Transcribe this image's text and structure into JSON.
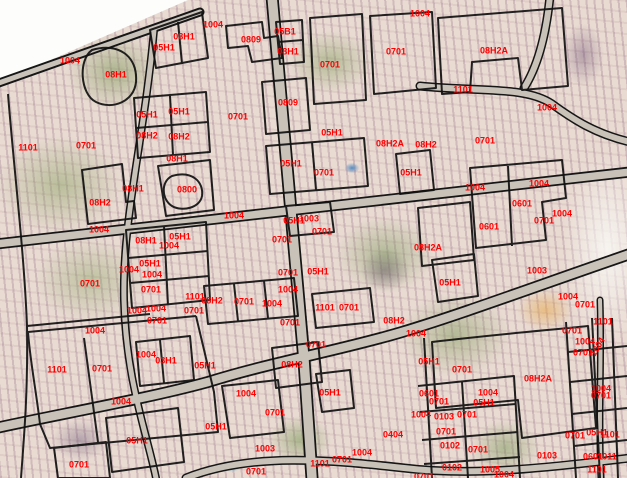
{
  "map": {
    "title": "cadastral parcel overlay on aerial imagery",
    "label_color": "#ff0000",
    "boundary_color": "#111111",
    "road_fill_color": "#c9c2b8",
    "labels": [
      {
        "t": "1004",
        "x": 70,
        "y": 61
      },
      {
        "t": "08H1",
        "x": 116,
        "y": 75
      },
      {
        "t": "05H1",
        "x": 164,
        "y": 48
      },
      {
        "t": "08H1",
        "x": 184,
        "y": 37
      },
      {
        "t": "05H1",
        "x": 147,
        "y": 115
      },
      {
        "t": "05H1",
        "x": 179,
        "y": 112
      },
      {
        "t": "08H2",
        "x": 147,
        "y": 136
      },
      {
        "t": "08H2",
        "x": 179,
        "y": 137
      },
      {
        "t": "1101",
        "x": 28,
        "y": 148
      },
      {
        "t": "0701",
        "x": 86,
        "y": 146
      },
      {
        "t": "08H1",
        "x": 177,
        "y": 159
      },
      {
        "t": "1004",
        "x": 213,
        "y": 25
      },
      {
        "t": "0809",
        "x": 251,
        "y": 40
      },
      {
        "t": "05B1",
        "x": 285,
        "y": 32
      },
      {
        "t": "08H1",
        "x": 288,
        "y": 52
      },
      {
        "t": "0701",
        "x": 330,
        "y": 65
      },
      {
        "t": "0701",
        "x": 396,
        "y": 52
      },
      {
        "t": "0809",
        "x": 288,
        "y": 103
      },
      {
        "t": "0701",
        "x": 238,
        "y": 117
      },
      {
        "t": "05H1",
        "x": 332,
        "y": 133
      },
      {
        "t": "08H2A",
        "x": 390,
        "y": 144
      },
      {
        "t": "1004",
        "x": 420,
        "y": 14
      },
      {
        "t": "08H2A",
        "x": 494,
        "y": 51
      },
      {
        "t": "1101",
        "x": 463,
        "y": 90
      },
      {
        "t": "1004",
        "x": 547,
        "y": 108
      },
      {
        "t": "0701",
        "x": 485,
        "y": 141
      },
      {
        "t": "08H2",
        "x": 426,
        "y": 145
      },
      {
        "t": "08H1",
        "x": 133,
        "y": 189
      },
      {
        "t": "0800",
        "x": 187,
        "y": 190
      },
      {
        "t": "08H2",
        "x": 100,
        "y": 203
      },
      {
        "t": "1004",
        "x": 99,
        "y": 230
      },
      {
        "t": "08H1",
        "x": 146,
        "y": 241
      },
      {
        "t": "05H1",
        "x": 180,
        "y": 237
      },
      {
        "t": "1004",
        "x": 169,
        "y": 246
      },
      {
        "t": "05H1",
        "x": 150,
        "y": 264
      },
      {
        "t": "1004",
        "x": 129,
        "y": 270
      },
      {
        "t": "1004",
        "x": 152,
        "y": 275
      },
      {
        "t": "0701",
        "x": 151,
        "y": 290
      },
      {
        "t": "0701",
        "x": 90,
        "y": 284
      },
      {
        "t": "1101",
        "x": 195,
        "y": 297
      },
      {
        "t": "0701",
        "x": 194,
        "y": 311
      },
      {
        "t": "1004",
        "x": 137,
        "y": 311
      },
      {
        "t": "1004",
        "x": 156,
        "y": 309
      },
      {
        "t": "0701",
        "x": 157,
        "y": 321
      },
      {
        "t": "08H2",
        "x": 212,
        "y": 301
      },
      {
        "t": "0701",
        "x": 244,
        "y": 302
      },
      {
        "t": "1004",
        "x": 272,
        "y": 304
      },
      {
        "t": "1004",
        "x": 234,
        "y": 216
      },
      {
        "t": "05H1",
        "x": 294,
        "y": 221
      },
      {
        "t": "1003",
        "x": 309,
        "y": 219
      },
      {
        "t": "0701",
        "x": 322,
        "y": 232
      },
      {
        "t": "0701",
        "x": 282,
        "y": 240
      },
      {
        "t": "0701",
        "x": 288,
        "y": 273
      },
      {
        "t": "05H1",
        "x": 318,
        "y": 272
      },
      {
        "t": "1004",
        "x": 288,
        "y": 290
      },
      {
        "t": "05H1",
        "x": 291,
        "y": 164
      },
      {
        "t": "0701",
        "x": 324,
        "y": 173
      },
      {
        "t": "05H1",
        "x": 411,
        "y": 173
      },
      {
        "t": "1101",
        "x": 325,
        "y": 308
      },
      {
        "t": "0701",
        "x": 349,
        "y": 308
      },
      {
        "t": "1004",
        "x": 475,
        "y": 188
      },
      {
        "t": "1004",
        "x": 539,
        "y": 184
      },
      {
        "t": "0601",
        "x": 522,
        "y": 204
      },
      {
        "t": "1004",
        "x": 562,
        "y": 214
      },
      {
        "t": "0701",
        "x": 544,
        "y": 221
      },
      {
        "t": "0601",
        "x": 489,
        "y": 227
      },
      {
        "t": "08H2A",
        "x": 428,
        "y": 248
      },
      {
        "t": "05H1",
        "x": 450,
        "y": 283
      },
      {
        "t": "1003",
        "x": 537,
        "y": 271
      },
      {
        "t": "1004",
        "x": 568,
        "y": 297
      },
      {
        "t": "0701",
        "x": 585,
        "y": 305
      },
      {
        "t": "1101",
        "x": 603,
        "y": 322
      },
      {
        "t": "0701",
        "x": 572,
        "y": 331
      },
      {
        "t": "1004",
        "x": 585,
        "y": 342
      },
      {
        "t": "1004",
        "x": 598,
        "y": 347,
        "r": -60
      },
      {
        "t": "0701",
        "x": 583,
        "y": 353
      },
      {
        "t": "1004",
        "x": 95,
        "y": 331
      },
      {
        "t": "1101",
        "x": 57,
        "y": 370
      },
      {
        "t": "0701",
        "x": 102,
        "y": 369
      },
      {
        "t": "1004",
        "x": 146,
        "y": 355
      },
      {
        "t": "03H1",
        "x": 166,
        "y": 361
      },
      {
        "t": "05H1",
        "x": 205,
        "y": 366
      },
      {
        "t": "1004",
        "x": 121,
        "y": 402
      },
      {
        "t": "05H1",
        "x": 137,
        "y": 441
      },
      {
        "t": "0701",
        "x": 79,
        "y": 465
      },
      {
        "t": "0701",
        "x": 290,
        "y": 323
      },
      {
        "t": "08H2",
        "x": 394,
        "y": 321
      },
      {
        "t": "0701",
        "x": 316,
        "y": 345
      },
      {
        "t": "1004",
        "x": 416,
        "y": 334
      },
      {
        "t": "08H2",
        "x": 292,
        "y": 365
      },
      {
        "t": "05H1",
        "x": 330,
        "y": 393
      },
      {
        "t": "1004",
        "x": 246,
        "y": 394
      },
      {
        "t": "0701",
        "x": 275,
        "y": 413
      },
      {
        "t": "05H1",
        "x": 216,
        "y": 427
      },
      {
        "t": "1003",
        "x": 265,
        "y": 449
      },
      {
        "t": "0701",
        "x": 256,
        "y": 472
      },
      {
        "t": "1101",
        "x": 320,
        "y": 464
      },
      {
        "t": "0701",
        "x": 342,
        "y": 460
      },
      {
        "t": "1004",
        "x": 362,
        "y": 453
      },
      {
        "t": "0404",
        "x": 393,
        "y": 435
      },
      {
        "t": "05H1",
        "x": 429,
        "y": 362
      },
      {
        "t": "0701",
        "x": 462,
        "y": 370
      },
      {
        "t": "08H2A",
        "x": 538,
        "y": 379
      },
      {
        "t": "1004",
        "x": 488,
        "y": 393
      },
      {
        "t": "05H1",
        "x": 484,
        "y": 403
      },
      {
        "t": "0601",
        "x": 429,
        "y": 394
      },
      {
        "t": "0701",
        "x": 439,
        "y": 402
      },
      {
        "t": "1004",
        "x": 421,
        "y": 415
      },
      {
        "t": "0103",
        "x": 444,
        "y": 417
      },
      {
        "t": "0701",
        "x": 467,
        "y": 415
      },
      {
        "t": "0701",
        "x": 446,
        "y": 432
      },
      {
        "t": "0102",
        "x": 450,
        "y": 446
      },
      {
        "t": "0701",
        "x": 478,
        "y": 450
      },
      {
        "t": "0102",
        "x": 452,
        "y": 468
      },
      {
        "t": "1005",
        "x": 490,
        "y": 470
      },
      {
        "t": "0701",
        "x": 424,
        "y": 477
      },
      {
        "t": "0103",
        "x": 547,
        "y": 456
      },
      {
        "t": "1004",
        "x": 601,
        "y": 389
      },
      {
        "t": "0701",
        "x": 601,
        "y": 396
      },
      {
        "t": "0701",
        "x": 575,
        "y": 436
      },
      {
        "t": "05H1",
        "x": 597,
        "y": 433
      },
      {
        "t": "1101",
        "x": 610,
        "y": 435
      },
      {
        "t": "0601",
        "x": 593,
        "y": 457
      },
      {
        "t": "1011",
        "x": 607,
        "y": 457
      },
      {
        "t": "1101",
        "x": 597,
        "y": 470
      },
      {
        "t": "1004",
        "x": 504,
        "y": 475
      }
    ]
  }
}
